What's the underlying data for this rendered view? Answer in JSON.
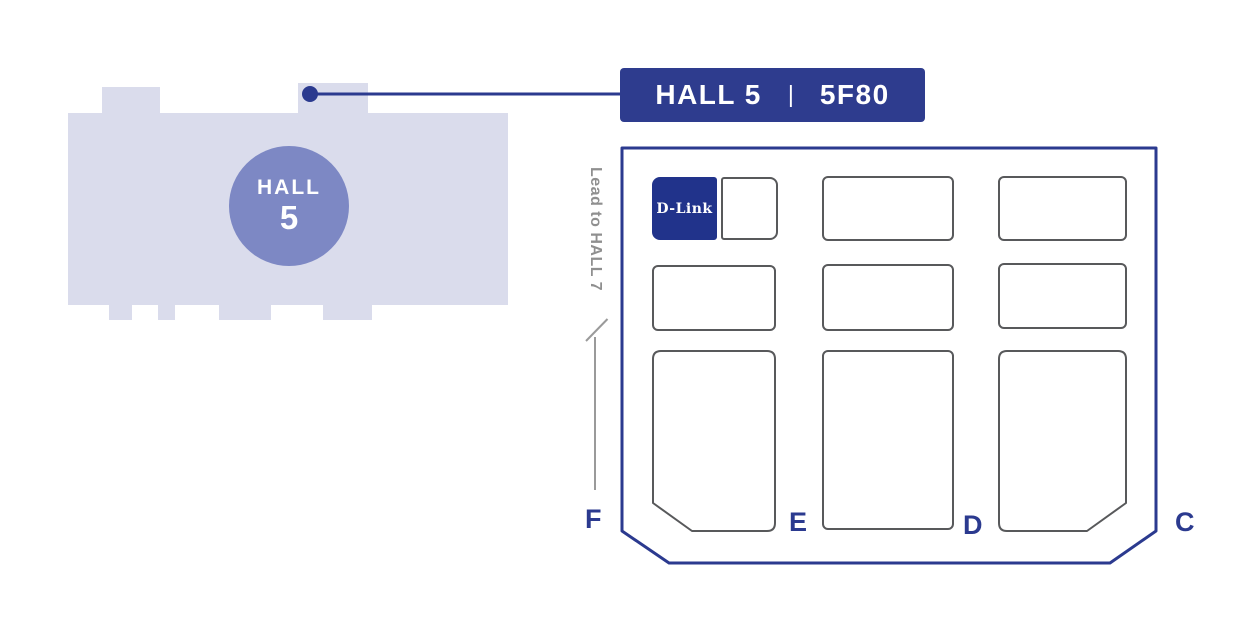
{
  "colors": {
    "primary_blue": "#2b3a8f",
    "banner_blue": "#2e3c8e",
    "dlink_blue": "#21338b",
    "building_fill": "#dadcec",
    "circle_fill": "#7d88c4",
    "booth_outline": "#58595b",
    "muted_gray": "#8f8f8f"
  },
  "overview": {
    "circle_label_line1": "HALL",
    "circle_label_line2": "5"
  },
  "callout": {
    "hall": "HALL 5",
    "separator": "|",
    "booth": "5F80"
  },
  "floor_plan": {
    "direction_label": "Lead to HALL 7",
    "highlight_booth_label": "D-Link",
    "aisle_labels": [
      "F",
      "E",
      "D",
      "C"
    ]
  }
}
